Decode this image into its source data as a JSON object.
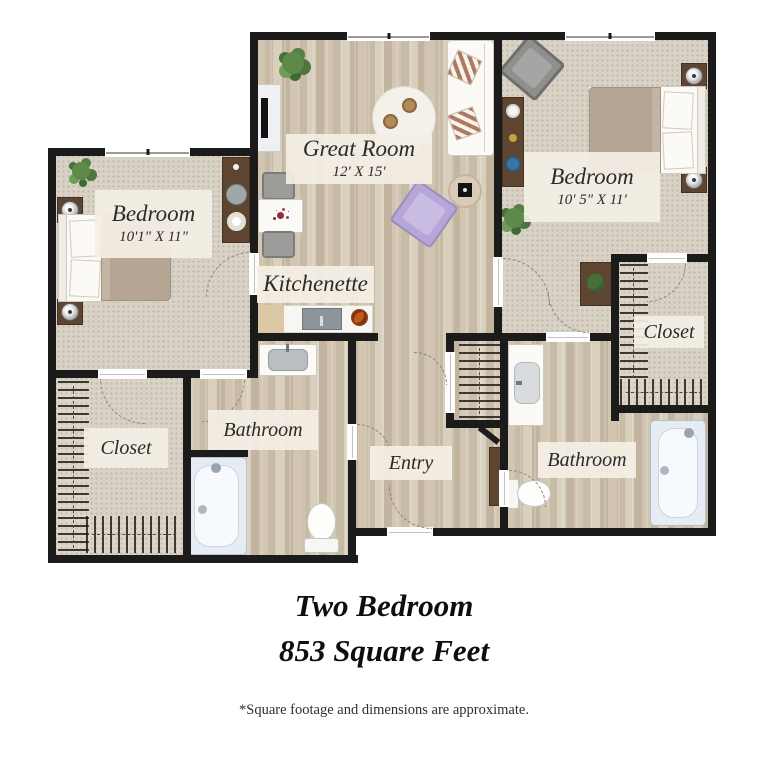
{
  "plan": {
    "rooms": {
      "great_room": {
        "label": "Great Room",
        "dims": "12' X 15'"
      },
      "bedroom_left": {
        "label": "Bedroom",
        "dims": "10'1\" X 11\""
      },
      "bedroom_right": {
        "label": "Bedroom",
        "dims": "10' 5\" X 11'"
      },
      "kitchenette": {
        "label": "Kitchenette"
      },
      "closet_left": {
        "label": "Closet"
      },
      "closet_right": {
        "label": "Closet"
      },
      "bathroom_left": {
        "label": "Bathroom"
      },
      "bathroom_right": {
        "label": "Bathroom"
      },
      "entry": {
        "label": "Entry"
      }
    },
    "colors": {
      "wall": "#1b1b1b",
      "carpet": "#d9d2c6",
      "wood": "#cfc3af",
      "label_bg": "#f4efe5",
      "furniture_wood": "#5e4531",
      "blanket": "#b5a694",
      "tub": "#e6ecf4",
      "plant": "#5d8a49",
      "accent_chair": "#b7a6d8"
    }
  },
  "footer": {
    "title": "Two Bedroom",
    "subtitle": "853 Square Feet",
    "disclaimer": "*Square footage and dimensions are approximate."
  }
}
